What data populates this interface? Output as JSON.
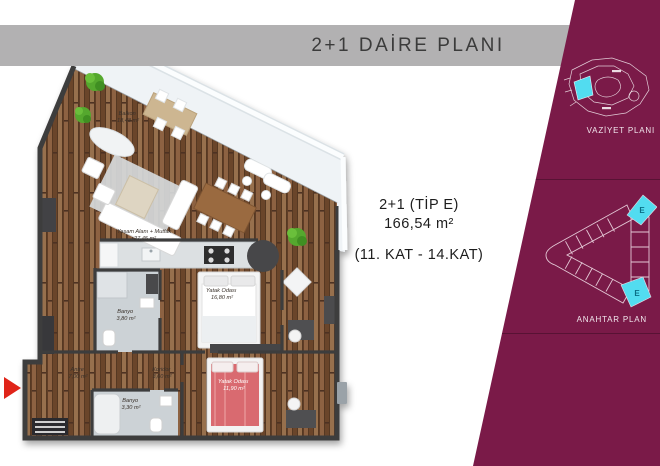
{
  "header": {
    "title": "2+1 DAİRE PLANI"
  },
  "info": {
    "line1": "2+1 (TİP E)",
    "line2": "166,54 m²",
    "line3": "(11. KAT - 14.KAT)"
  },
  "sidebar": {
    "vaziyet_label": "VAZİYET PLANI",
    "anahtar_label": "ANAHTAR PLAN",
    "unit_top": "E",
    "unit_bottom": "E"
  },
  "floorplan": {
    "rooms": [
      {
        "name": "Balkon",
        "area": "18,48 m²"
      },
      {
        "name": "Yaşam Alanı + Mutfak",
        "area": "27,45 m²"
      },
      {
        "name": "Yatak Odası",
        "area": "16,80 m²"
      },
      {
        "name": "Banyo",
        "area": "3,80 m²"
      },
      {
        "name": "Antre",
        "area": "7,00 m²"
      },
      {
        "name": "Koridor",
        "area": "3,60 m²"
      },
      {
        "name": "Banyo",
        "area": "3,30 m²"
      },
      {
        "name": "Yatak Odası",
        "area": "11,90 m²"
      }
    ]
  },
  "colors": {
    "sidebar_bg": "#7a1a48",
    "titlebar_bg": "#b2b1b2",
    "highlight_cyan": "#52dcf0",
    "entrance_arrow": "#e02419"
  }
}
